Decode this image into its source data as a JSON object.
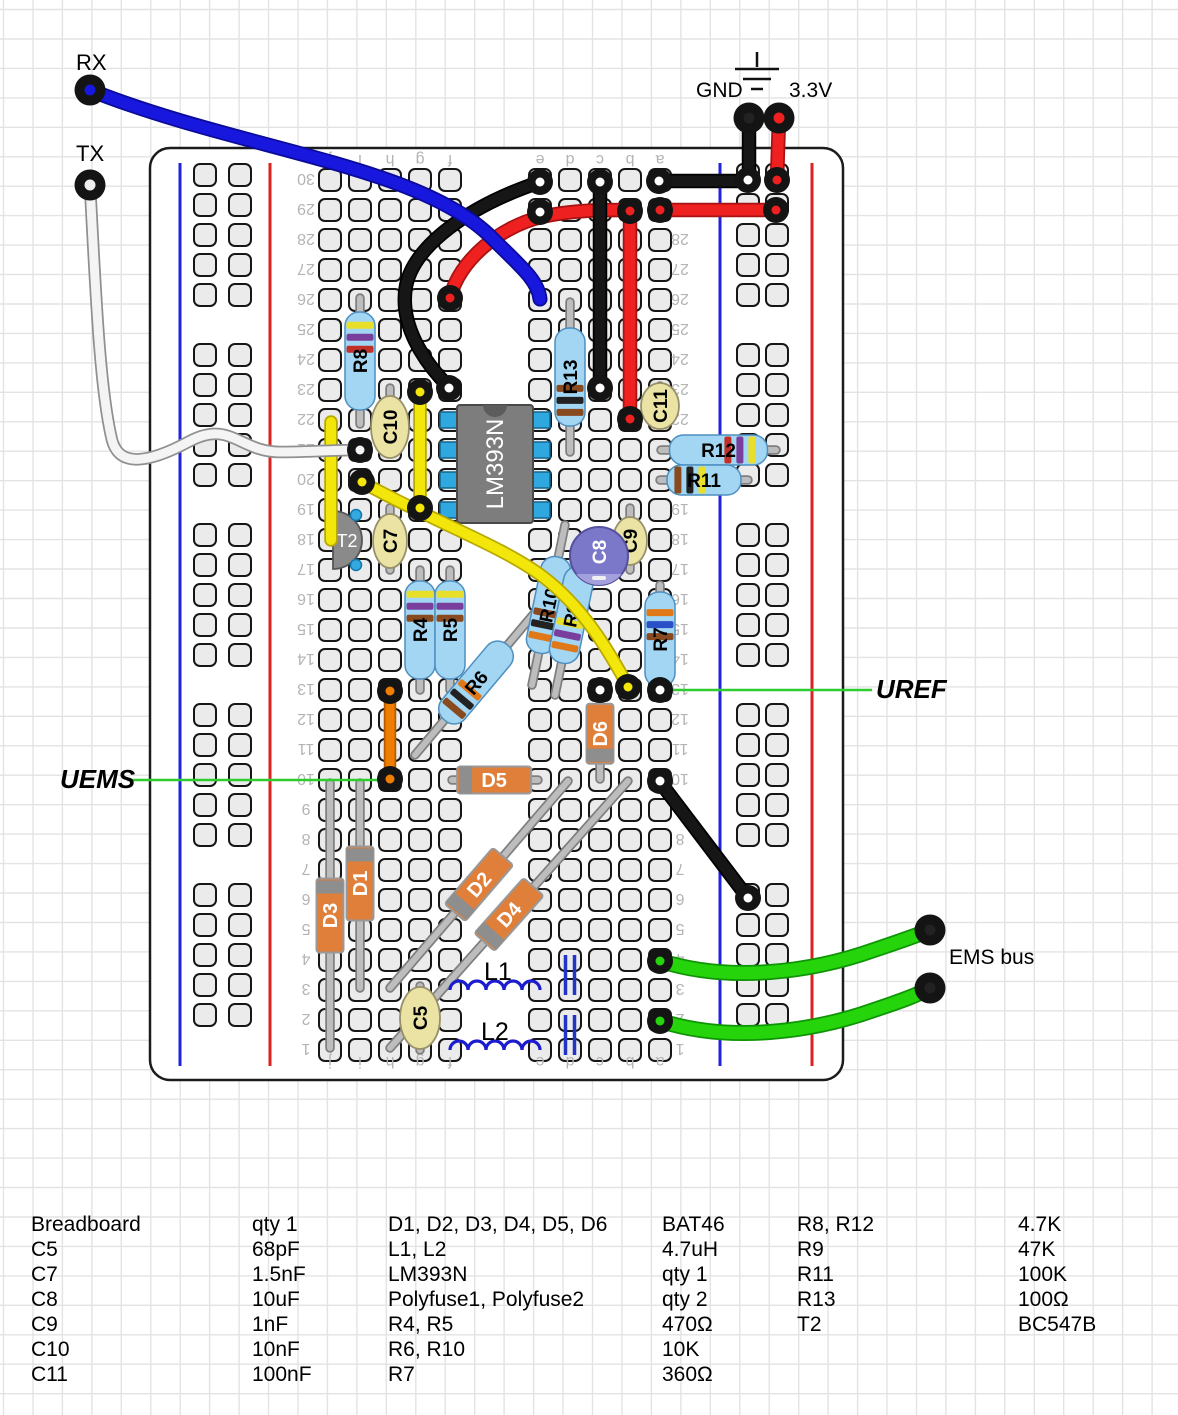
{
  "canvas": {
    "w": 1178,
    "h": 1415,
    "bg": "#ffffff",
    "grid": {
      "step": 29.45,
      "color": "#e3e3e3",
      "x0": 3.5,
      "y0": 9.5
    }
  },
  "annotations": {
    "rx": "RX",
    "tx": "TX",
    "gnd": "GND",
    "v33": "3.3V",
    "uems": "UEMS",
    "uref": "UREF",
    "ems_bus": "EMS bus"
  },
  "board": {
    "x": 150,
    "y": 148,
    "w": 693,
    "h": 932,
    "corner": 20,
    "stroke": "#1c1c1c",
    "fill": "#ffffff",
    "rows": 30,
    "row_y0": 180,
    "row_dy": 30,
    "cols": {
      "j": 330,
      "i": 360,
      "h": 390,
      "g": 420,
      "f": 450,
      "e": 540,
      "d": 570,
      "c": 600,
      "b": 630,
      "a": 660
    },
    "letter_y": [
      161,
      1063
    ],
    "number_x": [
      306,
      680
    ],
    "label_color": "#b4b4b4",
    "label_size": 16,
    "rails": [
      {
        "blue_x": 180,
        "red_x": 270,
        "hole_x": [
          205,
          240
        ]
      },
      {
        "blue_x": 720,
        "red_x": 812,
        "hole_x": [
          748,
          777
        ]
      }
    ],
    "rail_y1": 163,
    "rail_y2": 1066,
    "rail_groups": {
      "y0": 175,
      "groups": 5,
      "per_group": 5,
      "dy": 30,
      "group_gap": 180
    },
    "hole": {
      "size": 22,
      "rx": 6,
      "fill": "#ebebeb",
      "stroke": "#161616"
    }
  },
  "ground_symbol": {
    "stub": [
      757,
      52,
      757,
      67
    ],
    "bars": [
      [
        735,
        69,
        779,
        69
      ],
      [
        743,
        79,
        771,
        79
      ],
      [
        751,
        89,
        763,
        89
      ]
    ]
  },
  "leaders": [
    {
      "name": "uems-leader",
      "x1": 127,
      "y1": 780,
      "x2": 386,
      "y2": 780,
      "color": "#2ecc2e"
    },
    {
      "name": "uref-leader",
      "x1": 668,
      "y1": 690,
      "x2": 872,
      "y2": 690,
      "color": "#2ecc2e"
    }
  ],
  "components": {
    "ic": {
      "label": "LM393N",
      "x": 457,
      "y": 405,
      "w": 76,
      "h": 118,
      "body": "#7d7d7d",
      "notch": "#5c5c5c",
      "pin_color": "#2fa8e0",
      "pin_ys": [
        420,
        450,
        480,
        510
      ],
      "text": "#ffffff"
    },
    "resistors": [
      {
        "label": "R8",
        "x1": 360,
        "y1": 298,
        "x2": 360,
        "y2": 424,
        "bands": [
          "#e8df2a",
          "#7a3f9d",
          "#c03028"
        ],
        "bandsAt": 0.1
      },
      {
        "label": "R13",
        "x1": 570,
        "y1": 302,
        "x2": 570,
        "y2": 452,
        "bands": [
          "#8a4a20",
          "#222222",
          "#8a4a20"
        ],
        "bandsAt": 0.58
      },
      {
        "label": "R12",
        "x1": 661,
        "y1": 450,
        "x2": 776,
        "y2": 450,
        "bands": [
          "#c03028",
          "#7a3f9d",
          "#e8df2a"
        ],
        "bandsAt": 0.56
      },
      {
        "label": "R11",
        "x1": 660,
        "y1": 480,
        "x2": 748,
        "y2": 480,
        "bands": [
          "#8a4a20",
          "#222222",
          "#e8df2a"
        ],
        "bandsAt": 0.1
      },
      {
        "label": "R4",
        "x1": 420,
        "y1": 570,
        "x2": 420,
        "y2": 690,
        "bands": [
          "#e8df2a",
          "#7a3f9d",
          "#8a4a20"
        ],
        "bandsAt": 0.1
      },
      {
        "label": "R5",
        "x1": 450,
        "y1": 570,
        "x2": 450,
        "y2": 690,
        "bands": [
          "#e8df2a",
          "#7a3f9d",
          "#8a4a20"
        ],
        "bandsAt": 0.1
      },
      {
        "label": "R6",
        "x1": 415,
        "y1": 755,
        "x2": 537,
        "y2": 610,
        "bands": [
          "#8a4a20",
          "#222222",
          "#e07818"
        ],
        "bandsAt": 0.12
      },
      {
        "label": "R10",
        "x1": 565,
        "y1": 525,
        "x2": 532,
        "y2": 685,
        "bands": [
          "#8a4a20",
          "#222222",
          "#e07818"
        ],
        "bandsAt": 0.55
      },
      {
        "label": "R9",
        "x1": 588,
        "y1": 535,
        "x2": 555,
        "y2": 695,
        "bands": [
          "#e8df2a",
          "#7a3f9d",
          "#e07818"
        ],
        "bandsAt": 0.55
      },
      {
        "label": "R7",
        "x1": 660,
        "y1": 585,
        "x2": 660,
        "y2": 694,
        "bands": [
          "#e07818",
          "#2a50c8",
          "#8a4a20"
        ],
        "bandsAt": 0.18
      }
    ],
    "diodes": [
      {
        "label": "D3",
        "x1": 330,
        "y1": 783,
        "x2": 330,
        "y2": 1048,
        "bodyAt": 0.5,
        "bandAt": "p1"
      },
      {
        "label": "D1",
        "x1": 360,
        "y1": 783,
        "x2": 360,
        "y2": 988,
        "bodyAt": 0.49,
        "bandAt": "p1"
      },
      {
        "label": "D5",
        "x1": 452,
        "y1": 780,
        "x2": 538,
        "y2": 780,
        "bodyAt": 0.49,
        "bandAt": "p1"
      },
      {
        "label": "D6",
        "x1": 600,
        "y1": 692,
        "x2": 600,
        "y2": 779,
        "bodyAt": 0.48,
        "bandAt": "p2",
        "bodyLen": 60
      },
      {
        "label": "D2",
        "x1": 390,
        "y1": 988,
        "x2": 568,
        "y2": 781,
        "bodyAt": 0.5,
        "bandAt": "p1"
      },
      {
        "label": "D4",
        "x1": 390,
        "y1": 1048,
        "x2": 628,
        "y2": 781,
        "bodyAt": 0.5,
        "bandAt": "p1"
      }
    ],
    "caps": [
      {
        "label": "C10",
        "x": 390,
        "y1": 388,
        "y2": 452,
        "cy": 427,
        "rx": 19,
        "ry": 31
      },
      {
        "label": "C7",
        "x": 390,
        "y1": 508,
        "y2": 570,
        "cy": 541,
        "rx": 17,
        "ry": 27
      },
      {
        "label": "C9",
        "x": 630,
        "y1": 508,
        "y2": 570,
        "cy": 541,
        "rx": 17,
        "ry": 24
      },
      {
        "label": "C11",
        "x": 660,
        "y1": 386,
        "y2": 424,
        "cy": 406,
        "rx": 19,
        "ry": 23
      },
      {
        "label": "C5",
        "x": 420,
        "y1": 986,
        "y2": 1050,
        "cy": 1018,
        "rx": 20,
        "ry": 31
      }
    ],
    "cap_electrolytic": {
      "label": "C8",
      "cx": 599,
      "cy": 556,
      "r": 29,
      "fill": "#7b77c9",
      "stripe": "#a3a0dd",
      "stroke": "#55519e"
    },
    "transistor": {
      "label": "T2",
      "flat_x": 333,
      "cy": 540,
      "r": 29,
      "fill": "#8a8a8a",
      "dots": [
        [
          356,
          515
        ],
        [
          356,
          565
        ]
      ],
      "dot_color": "#35a8e0"
    },
    "inductors": [
      {
        "label": "L1",
        "x1": 450,
        "x2": 540,
        "y": 990,
        "lx": 484,
        "ly": 980
      },
      {
        "label": "L2",
        "x1": 450,
        "x2": 540,
        "y": 1050,
        "lx": 481,
        "ly": 1040
      }
    ],
    "polyfuses": [
      {
        "name": "Polyfuse1",
        "x": 570,
        "y1": 955,
        "y2": 995
      },
      {
        "name": "Polyfuse2",
        "x": 570,
        "y1": 1015,
        "y2": 1055
      }
    ]
  },
  "wires": [
    {
      "name": "red-jumper-f26-b29",
      "color": "#ee2020",
      "outline": "#a81212",
      "w": 11,
      "path": "M450,298 C459,260 500,227 541,217 C572,210 602,210 627,210"
    },
    {
      "name": "red-jumper-b29-b22",
      "color": "#ee2020",
      "outline": "#a81212",
      "w": 11,
      "path": "M630,213 L630,418"
    },
    {
      "name": "red-rail-jumper-29",
      "color": "#ee2020",
      "outline": "#a81212",
      "w": 11,
      "path": "M661,210 L775,210"
    },
    {
      "name": "red-v33-drop",
      "color": "#ee2020",
      "outline": "#a81212",
      "w": 11,
      "path": "M779,119 L777,179"
    },
    {
      "name": "black-gnd-drop",
      "color": "#161616",
      "outline": "#000000",
      "w": 11,
      "path": "M749,119 L749,179"
    },
    {
      "name": "black-rail-jumper-30",
      "color": "#161616",
      "outline": "#000000",
      "w": 11,
      "path": "M659,181 L748,181"
    },
    {
      "name": "black-arc-e30-f23",
      "color": "#161616",
      "outline": "#000000",
      "w": 11,
      "path": "M540,182 C468,206 414,246 406,286 C399,324 423,361 449,387"
    },
    {
      "name": "black-jumper-c30-c23",
      "color": "#161616",
      "outline": "#000000",
      "w": 11,
      "path": "M600,184 L600,388"
    },
    {
      "name": "black-jumper-a10-rail",
      "color": "#161616",
      "outline": "#000000",
      "w": 11,
      "path": "M660,782 L748,898"
    },
    {
      "name": "orange-jumper-h13-h10",
      "color": "#ef7d00",
      "outline": "#b35d00",
      "w": 9,
      "path": "M390,692 L390,778"
    },
    {
      "name": "yellow-jumper-j22-j18",
      "color": "#f2e60a",
      "outline": "#b8a800",
      "w": 10,
      "path": "M331,422 L331,540"
    },
    {
      "name": "yellow-jumper-g23-g19",
      "color": "#f2e60a",
      "outline": "#b8a800",
      "w": 10,
      "path": "M420,392 L420,508"
    },
    {
      "name": "yellow-uref-wire",
      "color": "#f2e60a",
      "outline": "#b8a800",
      "w": 10,
      "path": "M362,482 C432,521 502,546 542,576 C586,609 611,656 628,686"
    },
    {
      "name": "white-tx-wire",
      "color": "#f4f4f4",
      "outline": "#909090",
      "w": 9,
      "path": "M90,185 C96,300 100,390 112,440 C118,463 140,468 190,441 C230,420 240,452 280,452 C310,452 335,450 358,450"
    },
    {
      "name": "blue-rx-wire",
      "color": "#1717dd",
      "outline": "#0b0b99",
      "w": 11.5,
      "path": "M90,90 C240,150 420,165 492,238 C520,266 538,280 540,299"
    },
    {
      "name": "green-ems-wire-1",
      "color": "#25d40b",
      "outline": "#0f9405",
      "w": 12.5,
      "path": "M661,961 C730,983 812,972 874,950 C904,940 917,935 928,931"
    },
    {
      "name": "green-ems-wire-2",
      "color": "#25d40b",
      "outline": "#0f9405",
      "w": 12.5,
      "path": "M661,1021 C730,1043 812,1032 874,1010 C904,1000 917,995 928,989"
    }
  ],
  "rings": [
    [
      540,
      182,
      "#ffffff"
    ],
    [
      540,
      212,
      "#ffffff"
    ],
    [
      600,
      182,
      "#ffffff"
    ],
    [
      600,
      388,
      "#ffffff"
    ],
    [
      449,
      388,
      "#ffffff"
    ],
    [
      659,
      181,
      "#ffffff"
    ],
    [
      748,
      180,
      "#ffffff"
    ],
    [
      777,
      180,
      "#ee2020"
    ],
    [
      660,
      210,
      "#ee2020"
    ],
    [
      776,
      210,
      "#ee2020"
    ],
    [
      450,
      298,
      "#ee2020"
    ],
    [
      630,
      211,
      "#ee2020"
    ],
    [
      630,
      419,
      "#ee2020"
    ],
    [
      420,
      392,
      "#f2e60a"
    ],
    [
      420,
      508,
      "#f2e60a"
    ],
    [
      362,
      482,
      "#f2e60a"
    ],
    [
      628,
      687,
      "#f2e60a"
    ],
    [
      360,
      450,
      "#f4f4f4"
    ],
    [
      390,
      691,
      "#ef7d00"
    ],
    [
      390,
      779,
      "#ef7d00"
    ],
    [
      660,
      781,
      "#ffffff"
    ],
    [
      748,
      898,
      "#ffffff"
    ],
    [
      660,
      961,
      "#25d40b"
    ],
    [
      660,
      1021,
      "#25d40b"
    ],
    [
      600,
      690,
      "#ffffff"
    ],
    [
      660,
      690,
      "#ffffff"
    ]
  ],
  "pins": [
    {
      "name": "rx-pin",
      "x": 90,
      "y": 90,
      "c": "#1717dd"
    },
    {
      "name": "tx-pin",
      "x": 90,
      "y": 185,
      "c": "#eeeeee"
    },
    {
      "name": "gnd-pin",
      "x": 749,
      "y": 118,
      "c": "#222222"
    },
    {
      "name": "v33-pin",
      "x": 779,
      "y": 118,
      "c": "#ee2020"
    },
    {
      "name": "ems-pin-1",
      "x": 930,
      "y": 930,
      "c": "#222222"
    },
    {
      "name": "ems-pin-2",
      "x": 930,
      "y": 988,
      "c": "#222222"
    }
  ],
  "parts_list": {
    "col_x": [
      31,
      252,
      388,
      662,
      797,
      1018
    ],
    "row_y": [
      1231,
      1256,
      1281,
      1306,
      1331,
      1356,
      1381
    ],
    "font": 21,
    "rows": [
      [
        "Breadboard",
        "qty 1",
        "D1, D2, D3, D4, D5, D6",
        "BAT46",
        "R8, R12",
        "4.7K"
      ],
      [
        "C5",
        "68pF",
        "L1, L2",
        "4.7uH",
        "R9",
        "47K"
      ],
      [
        "C7",
        "1.5nF",
        "LM393N",
        "qty 1",
        "R11",
        "100K"
      ],
      [
        "C8",
        "10uF",
        "Polyfuse1, Polyfuse2",
        "qty 2",
        "R13",
        "100Ω"
      ],
      [
        "C9",
        "1nF",
        "R4, R5",
        "470Ω",
        "T2",
        "BC547B"
      ],
      [
        "C10",
        "10nF",
        "R6, R10",
        "10K",
        "",
        ""
      ],
      [
        "C11",
        "100nF",
        "R7",
        "360Ω",
        "",
        ""
      ]
    ]
  }
}
